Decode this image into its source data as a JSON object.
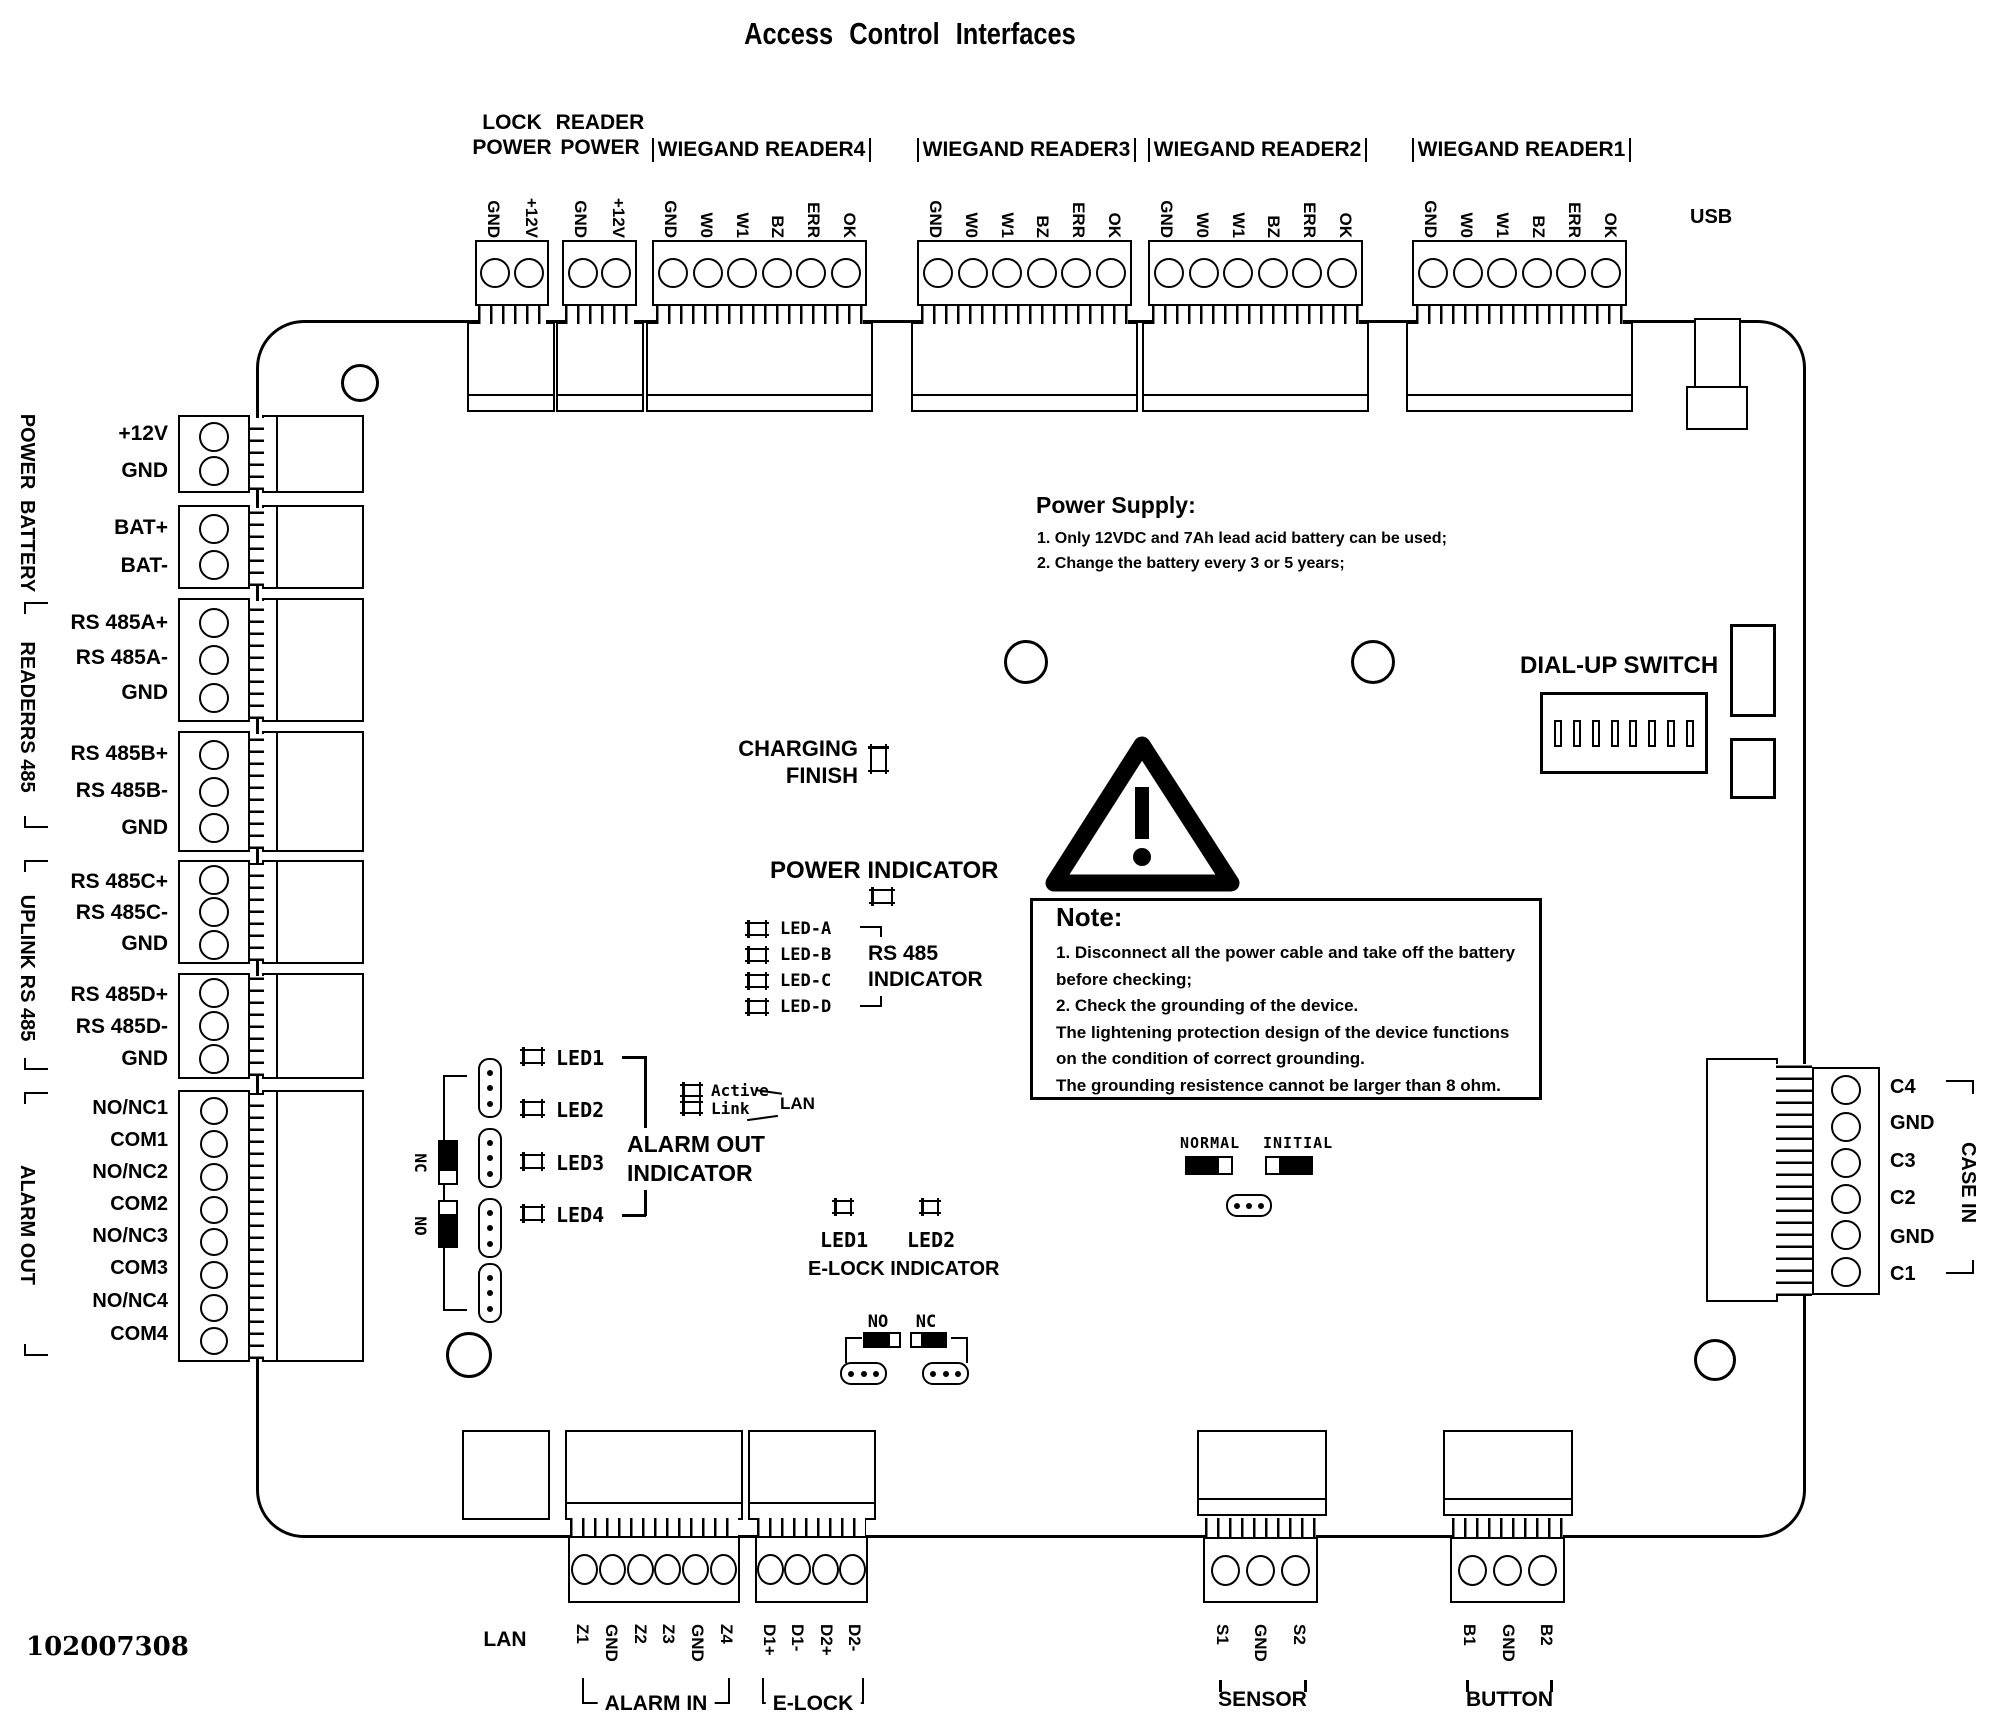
{
  "title": "Access Control Interfaces",
  "doc_number": "102007308",
  "usb": {
    "label": "USB"
  },
  "lan": {
    "label": "LAN"
  },
  "top": {
    "lock_power": {
      "line1": "LOCK",
      "line2": "POWER",
      "pins": [
        "GND",
        "+12V"
      ]
    },
    "reader_power": {
      "line1": "READER",
      "line2": "POWER",
      "pins": [
        "GND",
        "+12V"
      ]
    },
    "wiegand4": {
      "label": "WIEGAND READER4",
      "pins": [
        "GND",
        "W0",
        "W1",
        "BZ",
        "ERR",
        "OK"
      ]
    },
    "wiegand3": {
      "label": "WIEGAND READER3",
      "pins": [
        "GND",
        "W0",
        "W1",
        "BZ",
        "ERR",
        "OK"
      ]
    },
    "wiegand2": {
      "label": "WIEGAND READER2",
      "pins": [
        "GND",
        "W0",
        "W1",
        "BZ",
        "ERR",
        "OK"
      ]
    },
    "wiegand1": {
      "label": "WIEGAND READER1",
      "pins": [
        "GND",
        "W0",
        "W1",
        "BZ",
        "ERR",
        "OK"
      ]
    }
  },
  "left": {
    "power": {
      "group": "POWER",
      "pins": [
        "+12V",
        "GND"
      ]
    },
    "battery": {
      "group": "BATTERY",
      "pins": [
        "BAT+",
        "BAT-"
      ]
    },
    "readers485": {
      "group": "READERRS 485",
      "a": [
        "RS 485A+",
        "RS 485A-",
        "GND"
      ],
      "b": [
        "RS 485B+",
        "RS 485B-",
        "GND"
      ]
    },
    "uplink485": {
      "group": "UPLINK RS 485",
      "c": [
        "RS 485C+",
        "RS 485C-",
        "GND"
      ],
      "d": [
        "RS 485D+",
        "RS 485D-",
        "GND"
      ]
    },
    "alarm_out": {
      "group": "ALARM OUT",
      "pins": [
        "NO/NC1",
        "COM1",
        "NO/NC2",
        "COM2",
        "NO/NC3",
        "COM3",
        "NO/NC4",
        "COM4"
      ]
    }
  },
  "right": {
    "case_in": {
      "group": "CASE IN",
      "pins": [
        "C4",
        "GND",
        "C3",
        "C2",
        "GND",
        "C1"
      ]
    }
  },
  "bottom": {
    "alarm_in": {
      "label": "ALARM IN",
      "pins": [
        "Z1",
        "GND",
        "Z2",
        "Z3",
        "GND",
        "Z4"
      ]
    },
    "e_lock": {
      "label": "E-LOCK",
      "pins": [
        "D1+",
        "D1-",
        "D2+",
        "D2-"
      ]
    },
    "sensor": {
      "label": "SENSOR",
      "pins": [
        "S1",
        "GND",
        "S2"
      ]
    },
    "button": {
      "label": "BUTTON",
      "pins": [
        "B1",
        "GND",
        "B2"
      ]
    }
  },
  "notes": {
    "power_supply": {
      "title": "Power Supply:",
      "item1": "1. Only 12VDC and 7Ah lead acid battery can be used;",
      "item2": "2. Change the battery every 3 or 5 years;"
    },
    "note": {
      "title": "Note:",
      "line1": "1. Disconnect all the power cable and take off the battery",
      "line2": "before checking;",
      "line3": "2. Check the grounding of the device.",
      "line4": "The lightening protection design of the device functions",
      "line5": "on the condition of correct grounding.",
      "line6": "The grounding resistence cannot be larger than 8 ohm."
    }
  },
  "indicators": {
    "charging": {
      "line1": "CHARGING",
      "line2": "FINISH"
    },
    "power_indicator": "POWER INDICATOR",
    "rs485": {
      "led_a": "LED-A",
      "led_b": "LED-B",
      "led_c": "LED-C",
      "led_d": "LED-D",
      "label1": "RS 485",
      "label2": "INDICATOR"
    },
    "alarm_out_ind": {
      "led1": "LED1",
      "led2": "LED2",
      "led3": "LED3",
      "led4": "LED4",
      "label1": "ALARM OUT",
      "label2": "INDICATOR",
      "nc": "NC",
      "no": "NO"
    },
    "lan_leds": {
      "active": "Active",
      "link": "Link",
      "lan": "LAN"
    },
    "elock_ind": {
      "led1": "LED1",
      "led2": "LED2",
      "label": "E-LOCK INDICATOR",
      "no": "NO",
      "nc": "NC"
    },
    "mode": {
      "normal": "NORMAL",
      "initial": "INITIAL"
    },
    "dialup": "DIAL-UP SWITCH"
  }
}
